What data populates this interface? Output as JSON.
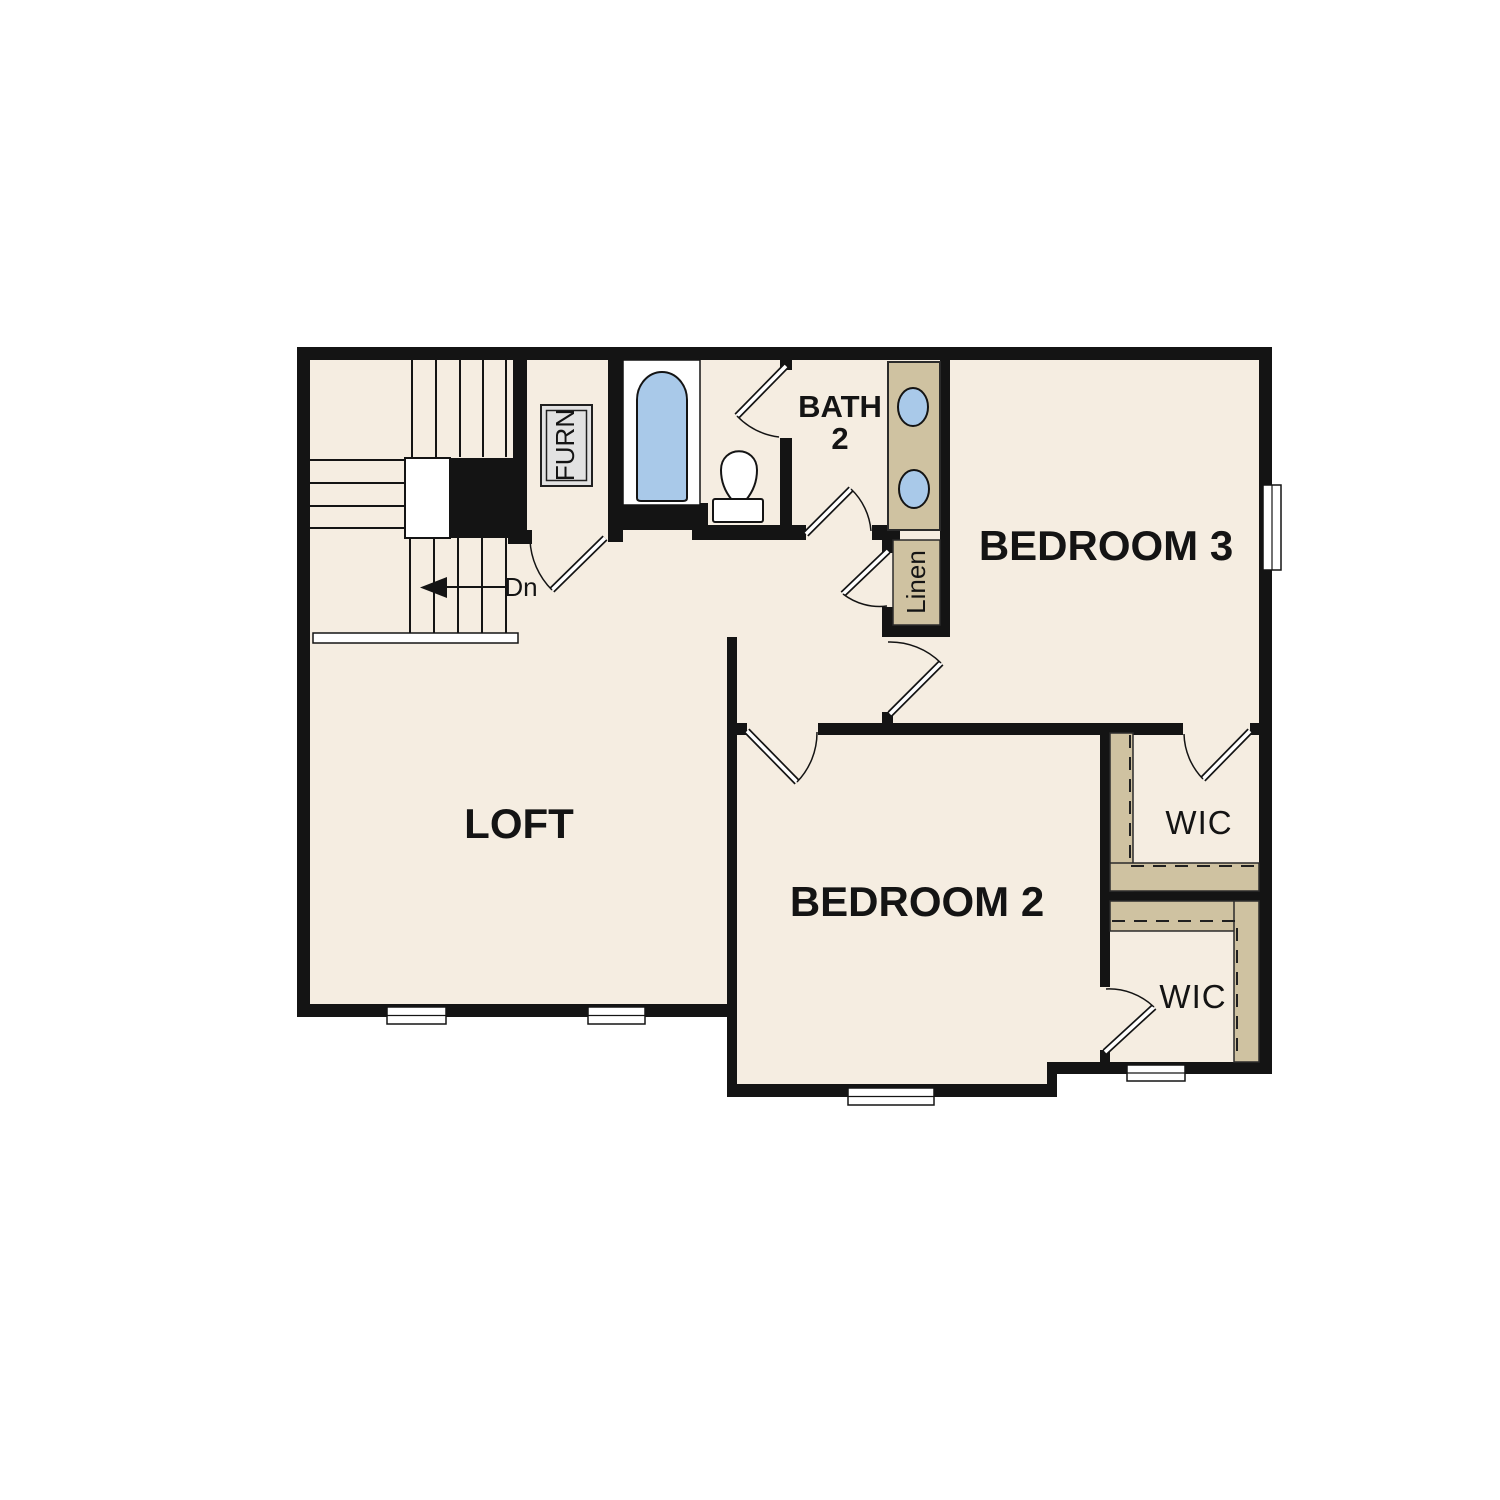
{
  "rooms": {
    "loft": {
      "label": "LOFT"
    },
    "bedroom2": {
      "label": "BEDROOM 2"
    },
    "bedroom3": {
      "label": "BEDROOM 3"
    },
    "bath2": {
      "line1": "BATH",
      "line2": "2"
    },
    "wic_upper": {
      "label": "WIC"
    },
    "wic_lower": {
      "label": "WIC"
    },
    "linen": {
      "label": "Linen"
    },
    "furn": {
      "label": "FURN"
    }
  },
  "stairs": {
    "down_label": "Dn"
  },
  "colors": {
    "background": "#ffffff",
    "floor": "#f5ede1",
    "wall": "#141414",
    "casework_tan": "#cfc2a1",
    "fixture_water_blue": "#a9c9e9",
    "furnace_box_grey": "#e2e2e2"
  }
}
